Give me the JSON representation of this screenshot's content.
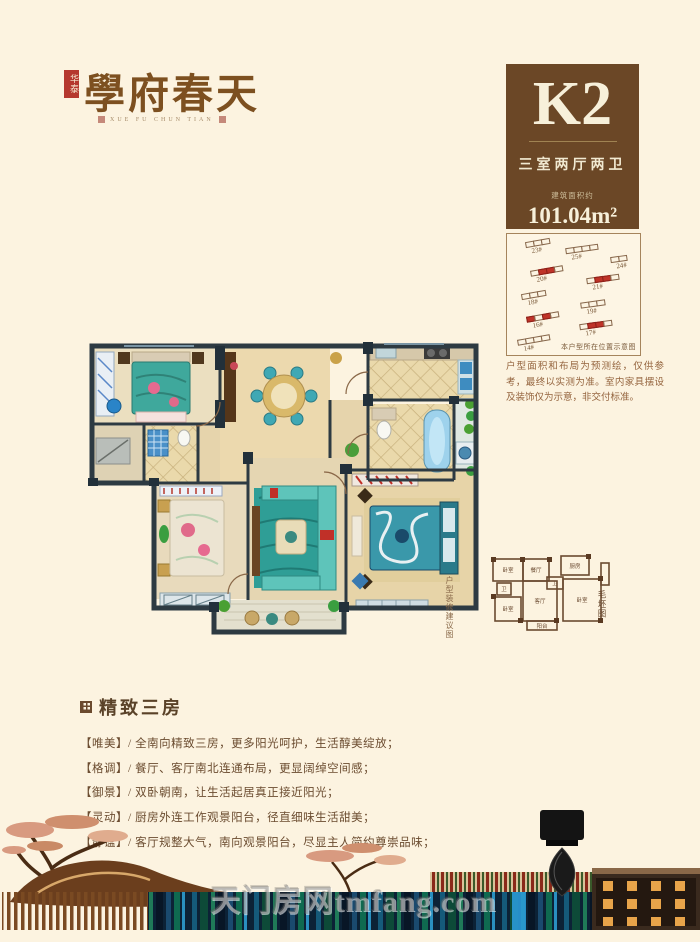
{
  "logo": {
    "seal": "华泰",
    "title": "學府春天",
    "pinyin": "XUE FU CHUN TIAN"
  },
  "unit_card": {
    "code": "K2",
    "layout": "三室两厅两卫",
    "area_label": "建筑面积约",
    "area": "101.04m²"
  },
  "site_plan": {
    "caption": "本户型所在位置示意图",
    "buildings": [
      {
        "label": "23#",
        "x": 14,
        "y": 5,
        "units": 3,
        "red": [],
        "rot": -10
      },
      {
        "label": "25#",
        "x": 44,
        "y": 10,
        "units": 4,
        "red": [],
        "rot": -8
      },
      {
        "label": "24#",
        "x": 78,
        "y": 18,
        "units": 2,
        "red": [],
        "rot": -8
      },
      {
        "label": "20#",
        "x": 18,
        "y": 28,
        "units": 4,
        "red": [
          1,
          2
        ],
        "rot": -10
      },
      {
        "label": "21#",
        "x": 60,
        "y": 35,
        "units": 4,
        "red": [
          1,
          2
        ],
        "rot": -8
      },
      {
        "label": "18#",
        "x": 11,
        "y": 48,
        "units": 3,
        "red": [],
        "rot": -10
      },
      {
        "label": "19#",
        "x": 56,
        "y": 55,
        "units": 3,
        "red": [],
        "rot": -8
      },
      {
        "label": "16#",
        "x": 15,
        "y": 66,
        "units": 4,
        "red": [
          0,
          2
        ],
        "rot": -10
      },
      {
        "label": "17#",
        "x": 55,
        "y": 73,
        "units": 4,
        "red": [
          1,
          2
        ],
        "rot": -8
      },
      {
        "label": "14#",
        "x": 8,
        "y": 85,
        "units": 4,
        "red": [],
        "rot": -10
      }
    ]
  },
  "disclaimer": "户型面积和布局为预测绘，仅供参考，最终以实测为准。室内家具摆设及装饰仅为示意，非交付标准。",
  "floorplan": {
    "caption": "户型装修建议图"
  },
  "schematic": {
    "caption": "毛坯图",
    "labels": [
      "卧室",
      "餐厅",
      "厨房",
      "卫",
      "卫",
      "卧室",
      "客厅",
      "卧室",
      "阳台"
    ]
  },
  "features": {
    "heading": "精致三房",
    "items": [
      "【唯美】/ 全南向精致三房，更多阳光呵护，生活醇美绽放；",
      "【格调】/ 餐厅、客厅南北连通布局，更显阔绰空间感；",
      "【御景】/ 双卧朝南，让生活起居真正接近阳光；",
      "【灵动】/ 厨房外连工作观景阳台，径直细味生活甜美；",
      "【静谧】/ 客厅规整大气，南向观景阳台，尽显主人简约尊崇品味；"
    ]
  },
  "watermark": "天门房网tmfang.com",
  "colors": {
    "background": "#fcf3e0",
    "card_brown": "#6b4726",
    "seal_red": "#b5382e",
    "highlight_red": "#bf3328",
    "wall_dark": "#2d3a42",
    "teal": "#3fa89c"
  }
}
